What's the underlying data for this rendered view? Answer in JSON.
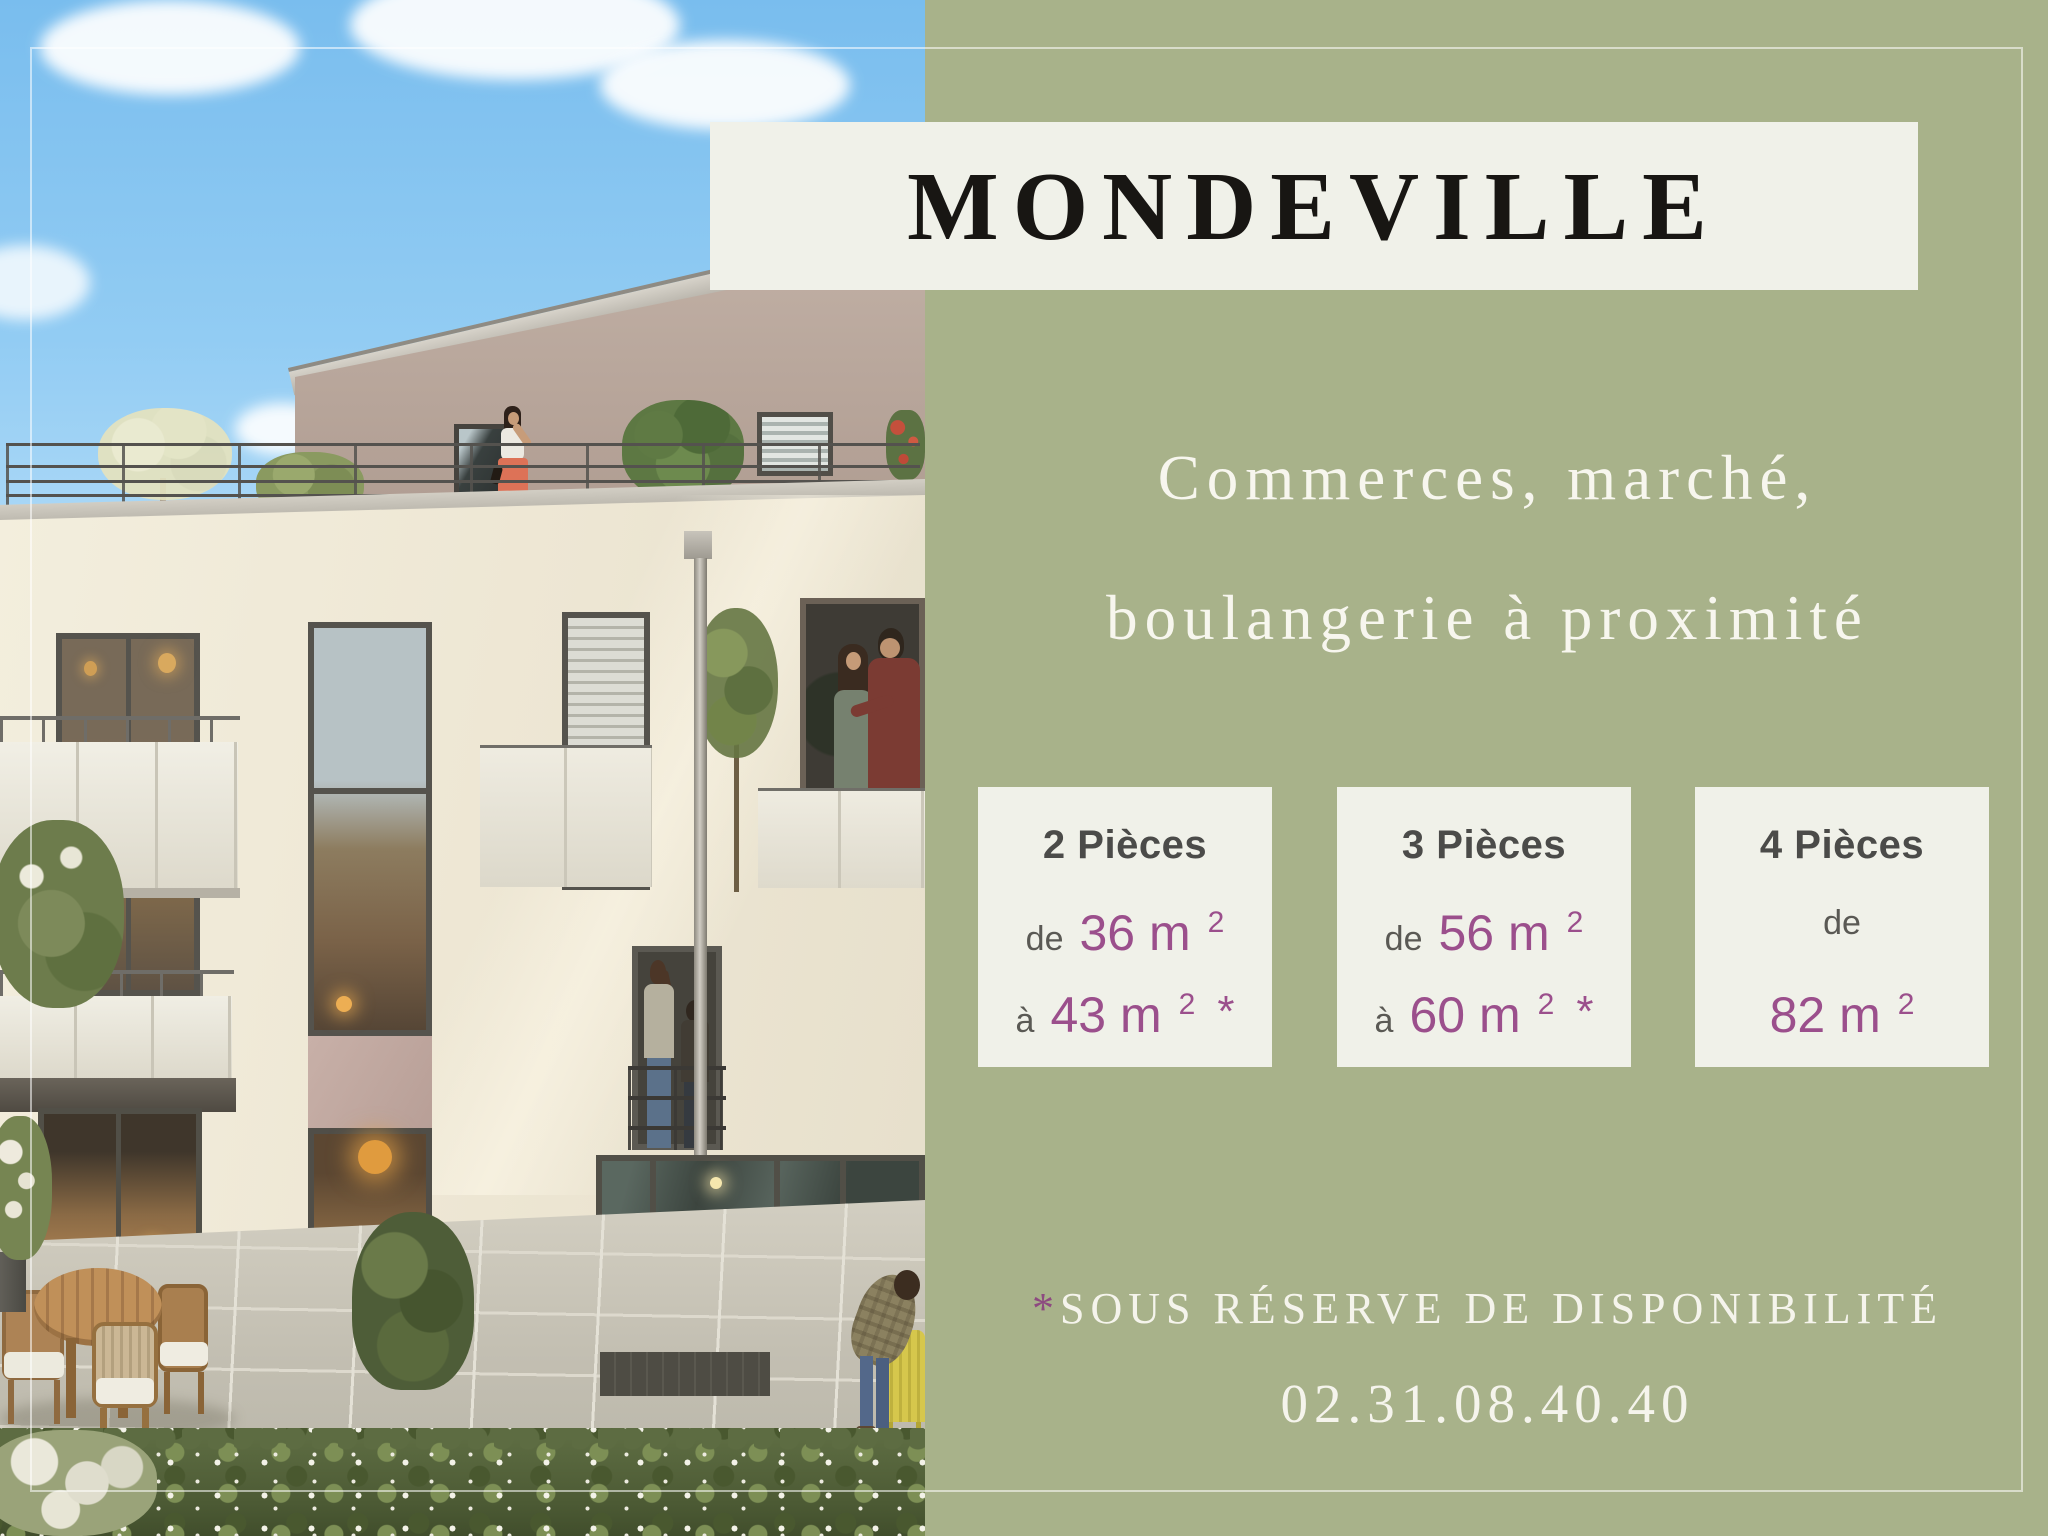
{
  "palette": {
    "panel_green": "#a8b28a",
    "card_bg": "#f0f1e9",
    "banner_bg": "#f0f1e9",
    "accent_purple": "#9b4f8c",
    "asterisk_purple": "#8d4a80",
    "heading_dark": "#4b4b49",
    "text_light": "#f5f4ec",
    "title_black": "#181613",
    "sky_blue": "#79bdee",
    "building_cream": "#efe9d8",
    "penthouse_taupe": "#b9a79c"
  },
  "banner": {
    "title": "MONDEVILLE"
  },
  "subtitle": {
    "line1": "Commerces, marché,",
    "line2": "boulangerie à proximité"
  },
  "cards": [
    {
      "title": "2 Pièces",
      "rows": [
        {
          "prefix": "de",
          "value": "36 m",
          "sup": "2",
          "suffix": ""
        },
        {
          "prefix": "à",
          "value": "43 m",
          "sup": "2",
          "suffix": "*"
        }
      ]
    },
    {
      "title": "3 Pièces",
      "rows": [
        {
          "prefix": "de",
          "value": "56 m",
          "sup": "2",
          "suffix": ""
        },
        {
          "prefix": "à",
          "value": "60 m",
          "sup": "2",
          "suffix": "*"
        }
      ]
    },
    {
      "title": "4 Pièces",
      "rows": [
        {
          "prefix": "de",
          "value": "",
          "sup": "",
          "suffix": ""
        },
        {
          "prefix": "",
          "value": "82 m",
          "sup": "2",
          "suffix": ""
        }
      ]
    }
  ],
  "footer": {
    "note_mark": "*",
    "note": "SOUS RÉSERVE DE DISPONIBILITÉ",
    "phone": "02.31.08.40.40"
  }
}
